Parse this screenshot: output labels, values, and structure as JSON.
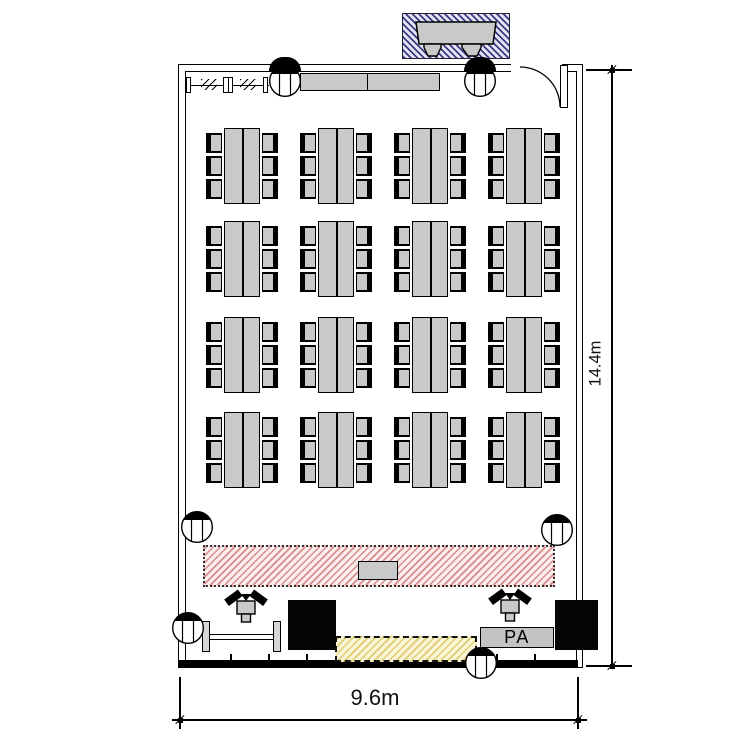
{
  "title": "Event room floor plan",
  "labels": {
    "pa": "PA",
    "room_width": "9.6m",
    "room_height": "14.4m"
  },
  "colors": {
    "line": "#000000",
    "furniture_gray": "#c9c9c9",
    "stage_stripe": "#d98c8c",
    "stage_bg": "#faeeee",
    "booth_stripe": "#3a3a85",
    "booth_bg": "#e4e4f2",
    "floor_stripe": "#e0cc6e",
    "floor_bg": "#fbf5d8"
  },
  "layout": {
    "tables": {
      "cols": [
        224,
        318,
        412,
        506
      ],
      "rows": [
        128,
        221,
        317,
        412
      ],
      "table_w": 36,
      "table_h": 76,
      "chair_offsets": [
        5,
        28,
        51
      ],
      "chairs_per_side": 3,
      "group_count": 16
    },
    "fixtures": [
      {
        "x": 285,
        "y": 81
      },
      {
        "x": 480,
        "y": 81
      },
      {
        "x": 197,
        "y": 527
      },
      {
        "x": 557,
        "y": 530
      },
      {
        "x": 188,
        "y": 628
      },
      {
        "x": 481,
        "y": 663
      }
    ],
    "speakers": [
      {
        "x": 246,
        "y": 589
      },
      {
        "x": 510,
        "y": 588
      }
    ],
    "wall_ticks": {
      "start_x": 230,
      "step": 38,
      "count": 9,
      "y": 654,
      "h": 7
    }
  }
}
